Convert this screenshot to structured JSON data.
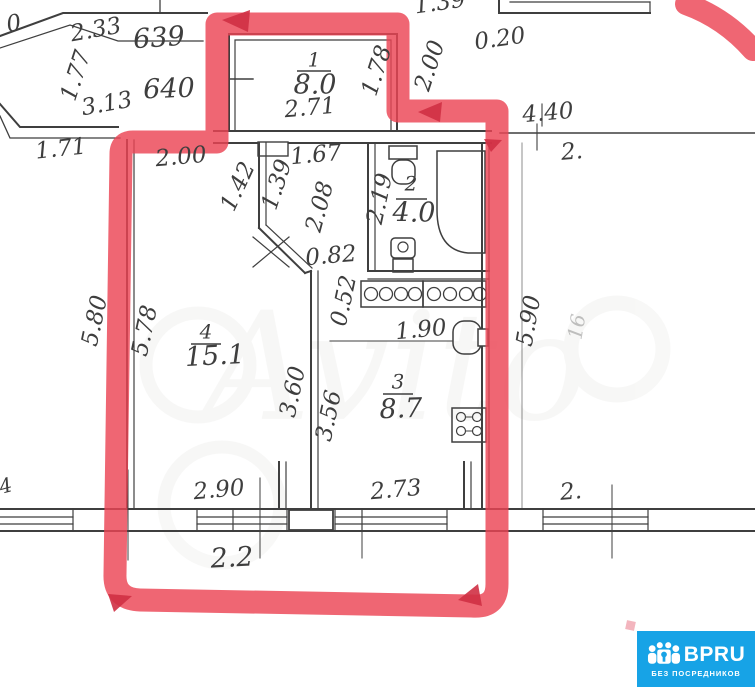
{
  "plan": {
    "highlight_color": "#ec4454",
    "line_color": "#3f3f3f",
    "rooms": [
      {
        "number": "1",
        "area": "8.0"
      },
      {
        "number": "2",
        "area": "4.0"
      },
      {
        "number": "3",
        "area": "8.7"
      },
      {
        "number": "4",
        "area": "15.1"
      }
    ],
    "unit_numbers": {
      "upper": "639",
      "lower": "640",
      "cut_top_left": "0"
    },
    "dims": {
      "d233": "2.33",
      "d177": "1.77",
      "d313": "3.13",
      "d171": "1.71",
      "d139top": "1.39",
      "d020": "0.20",
      "d200r": "2.00",
      "d440": "4.40",
      "d2top": "2.",
      "d271": "2.71",
      "d178": "1.78",
      "d200": "2.00",
      "d142": "1.42",
      "d139": "1.39",
      "d167": "1.67",
      "d208": "2.08",
      "d219": "2.19",
      "d082": "0.82",
      "d052": "0.52",
      "d190": "1.90",
      "d578": "5.78",
      "d580": "5.80",
      "d360": "3.60",
      "d356": "3.56",
      "d590": "5.90",
      "f16": "16",
      "d290": "2.90",
      "d273": "2.73",
      "d22": "2.2",
      "d2bot": "2.",
      "d4left": "4"
    }
  },
  "watermark": {
    "text": "Avito"
  },
  "badge": {
    "brand": "BPRU",
    "tagline": "БЕЗ ПОСРЕДНИКОВ"
  }
}
